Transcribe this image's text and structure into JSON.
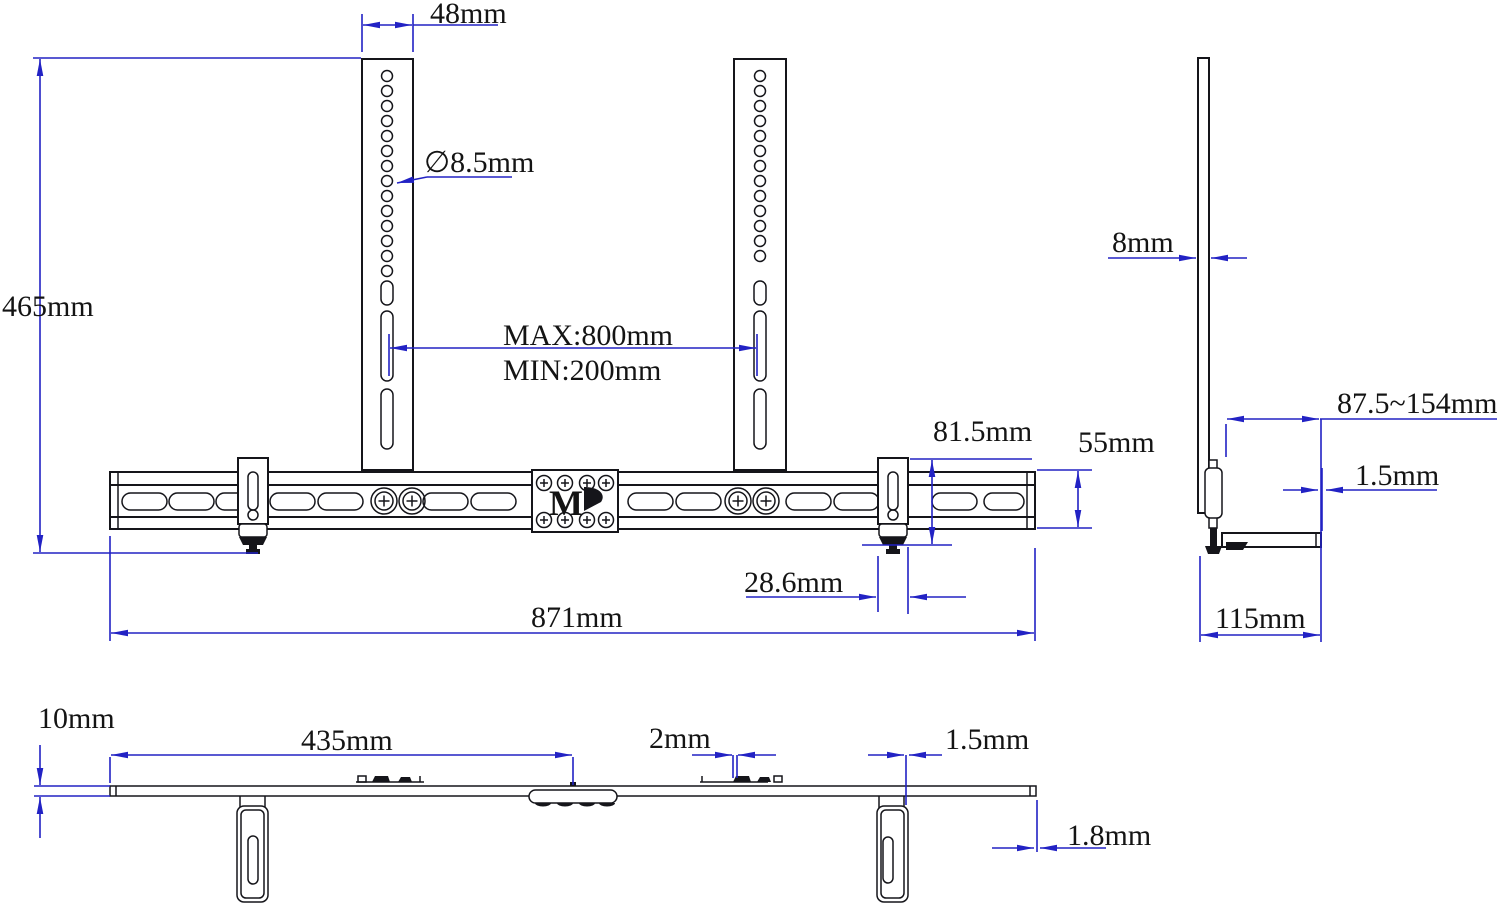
{
  "drawing": {
    "product": "soundbar-mount-dimension-drawing",
    "accent_color": "#2222c4",
    "line_color": "#15151a",
    "front_view": {
      "arm_width": "48mm",
      "total_height": "465mm",
      "hole_diameter": "∅8.5mm",
      "vesa_max": "MAX:800mm",
      "vesa_min": "MIN:200mm",
      "clamp_height": "81.5mm",
      "rail_height": "55mm",
      "clamp_width": "28.6mm",
      "total_width": "871mm"
    },
    "side_view": {
      "plate_thickness": "8mm",
      "depth_range": "87.5~154mm",
      "lip_thickness": "1.5mm",
      "base_depth": "115mm"
    },
    "bottom_view": {
      "bar_thickness": "10mm",
      "center_offset": "435mm",
      "tab_gap": "2mm",
      "bracket_gap": "1.5mm",
      "end_thickness": "1.8mm"
    },
    "logo": {
      "letter": "M"
    }
  }
}
